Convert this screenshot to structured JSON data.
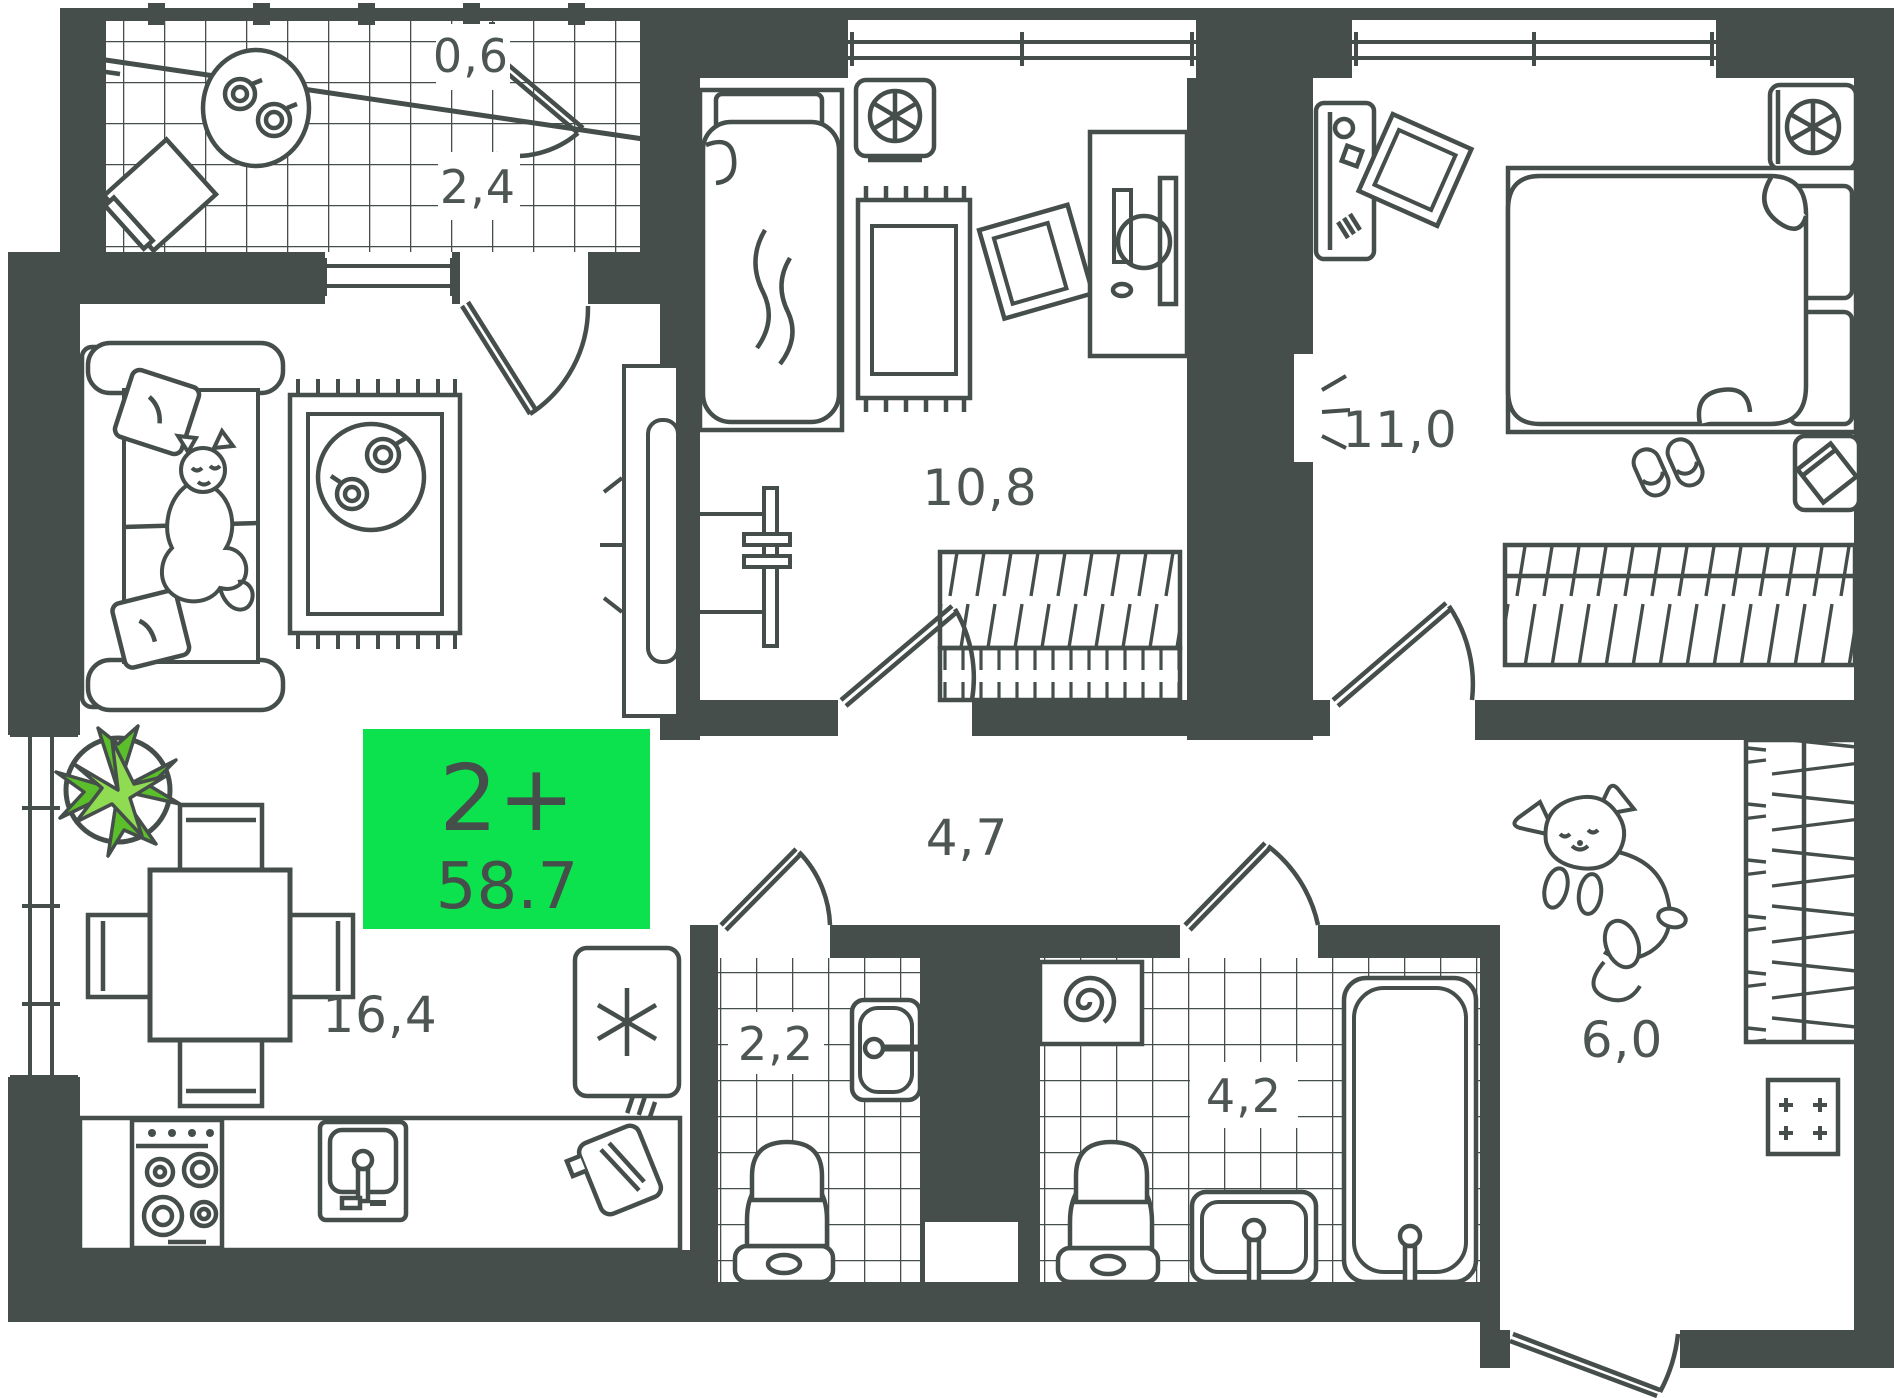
{
  "badge": {
    "rooms_type": "2+",
    "total_area": "58.7"
  },
  "labels": {
    "storage_top": "0,6",
    "loggia_top": "2,4",
    "bedroom_one": "10,8",
    "bedroom_two": "11,0",
    "hall": "4,7",
    "living_kitchen": "16,4",
    "wc": "2,2",
    "bathroom": "4,2",
    "loggia_right": "6,0"
  },
  "colors": {
    "wall": "#454e4b",
    "accent": "#0be24e",
    "text": "#4d5653",
    "plant_dark": "#5bbe2b",
    "plant_light": "#8fdb51",
    "background": "#ffffff"
  }
}
